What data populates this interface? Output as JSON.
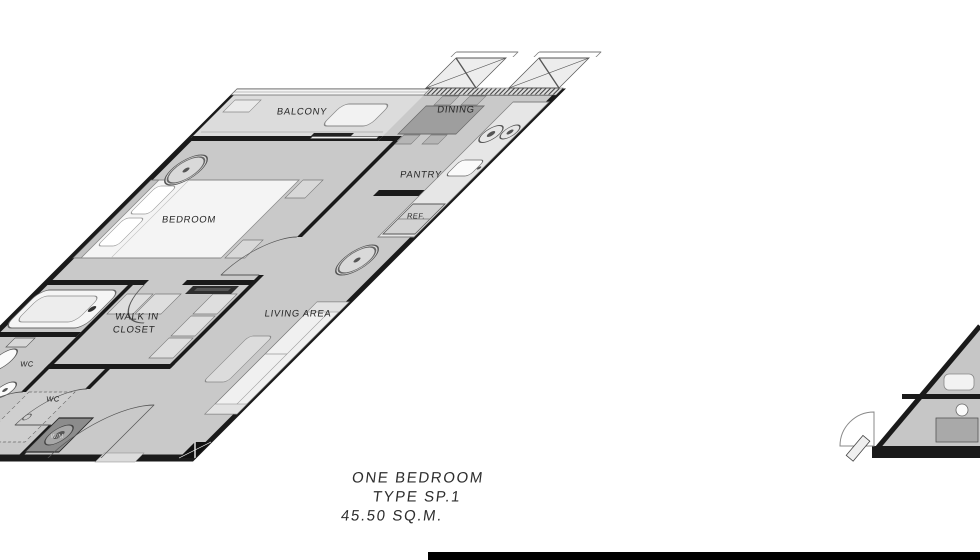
{
  "plan": {
    "labels": {
      "balcony": "BALCONY",
      "dining": "DINING",
      "pantry": "PANTRY",
      "refrigerator": "REF.",
      "bedroom": "BEDROOM",
      "walk_in_line1": "WALK IN",
      "walk_in_line2": "CLOSET",
      "wc_upper": "WC",
      "wc_lower": "WC",
      "washing_machine": "W/M",
      "living_area": "LIVING AREA"
    },
    "icons": {
      "fan_coil": "fan-coil-icon",
      "ac_condenser": "ac-condenser-icon",
      "stove_burners": "stove-burner-icon",
      "door_swing": "door-swing-arc-icon",
      "column_marker": "column-x-icon"
    },
    "colors": {
      "wall": "#1a1a1a",
      "floor": "#c9c9c9",
      "floor_light": "#dcdcdc",
      "furniture_light": "#f3f3f3",
      "furniture_mid": "#d8d8d8",
      "furniture_dark": "#9e9e9e",
      "washer_dark": "#8c8c8c",
      "text": "#2a2a2a"
    }
  },
  "caption": {
    "line1": "ONE BEDROOM",
    "line2": "TYPE SP.1",
    "line3": "45.50 SQ.M."
  },
  "footer": {
    "bar_color": "#000000"
  }
}
